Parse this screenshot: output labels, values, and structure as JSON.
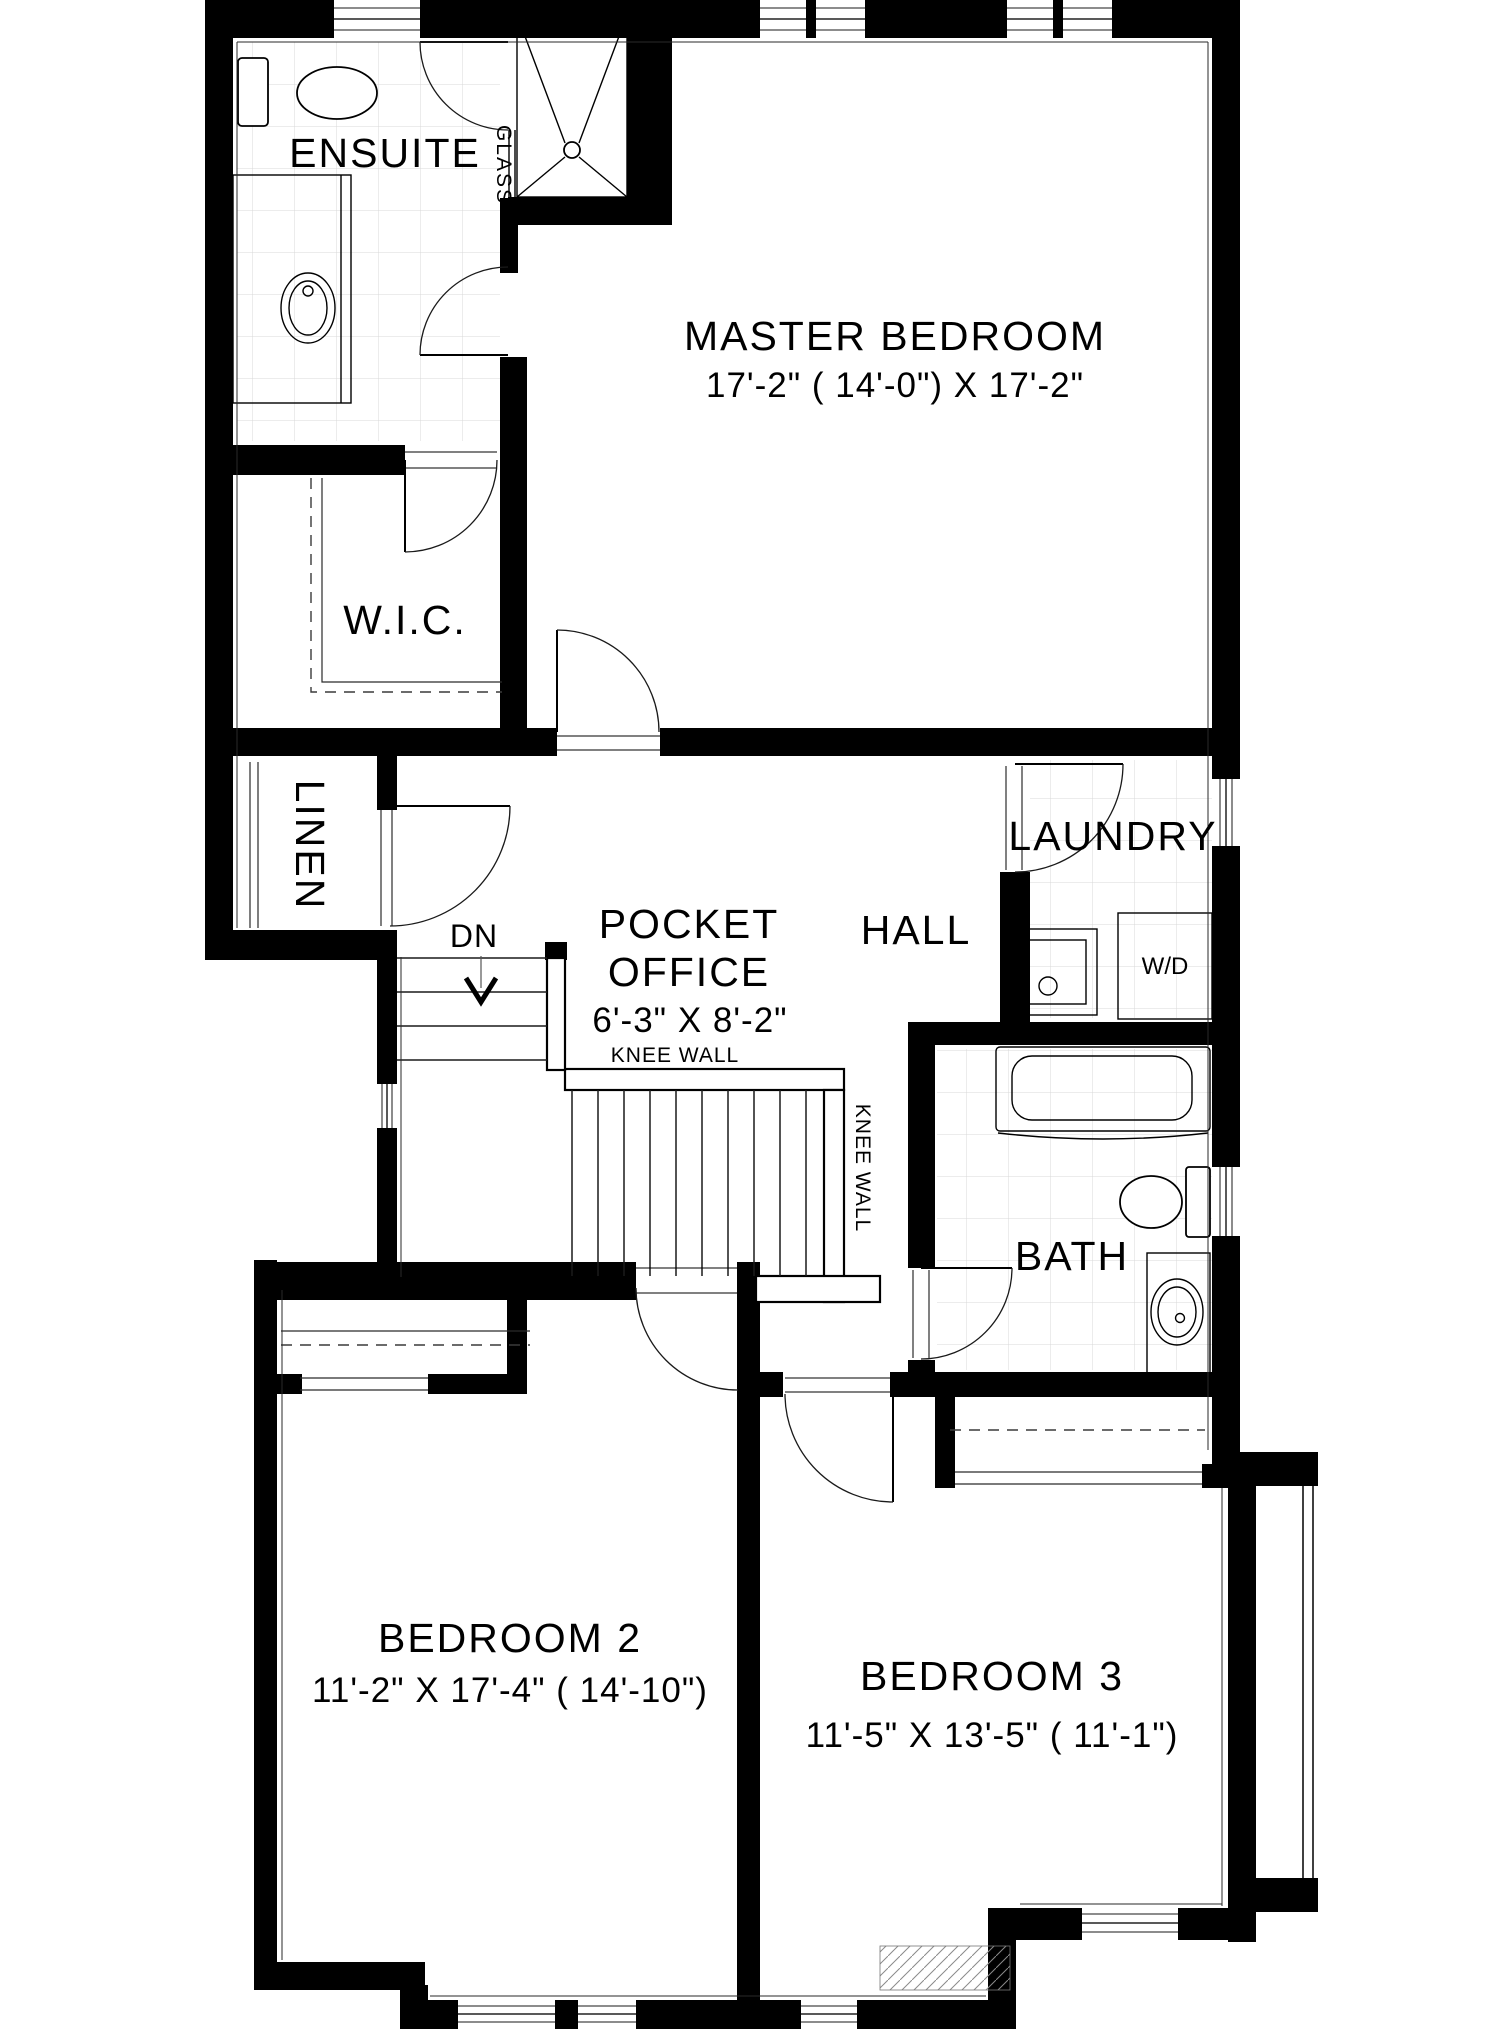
{
  "plan": {
    "rooms": {
      "ensuite": {
        "label": "ENSUITE"
      },
      "master": {
        "label": "MASTER BEDROOM",
        "dims": "17'-2\" ( 14'-0\")  X 17'-2\""
      },
      "wic": {
        "label": "W.I.C."
      },
      "linen": {
        "label": "LINEN"
      },
      "office": {
        "label_line1": "POCKET",
        "label_line2": "OFFICE",
        "dims": "6'-3\" X 8'-2\""
      },
      "hall": {
        "label": "HALL"
      },
      "laundry": {
        "label": "LAUNDRY",
        "appliance": "W/D"
      },
      "bath": {
        "label": "BATH"
      },
      "bedroom2": {
        "label": "BEDROOM 2",
        "dims": "11'-2\" X 17'-4\"  ( 14'-10\")"
      },
      "bedroom3": {
        "label": "BEDROOM 3",
        "dims": "11'-5\" X 13'-5\"  ( 11'-1\")"
      }
    },
    "stairs": {
      "direction_label": "DN"
    },
    "annotations": {
      "glass": "GLASS",
      "knee_wall_horizontal": "KNEE WALL",
      "knee_wall_vertical": "KNEE WALL"
    },
    "colors": {
      "wall": "#000000",
      "tile_line": "#d8d8d8",
      "paper": "#ffffff"
    }
  }
}
